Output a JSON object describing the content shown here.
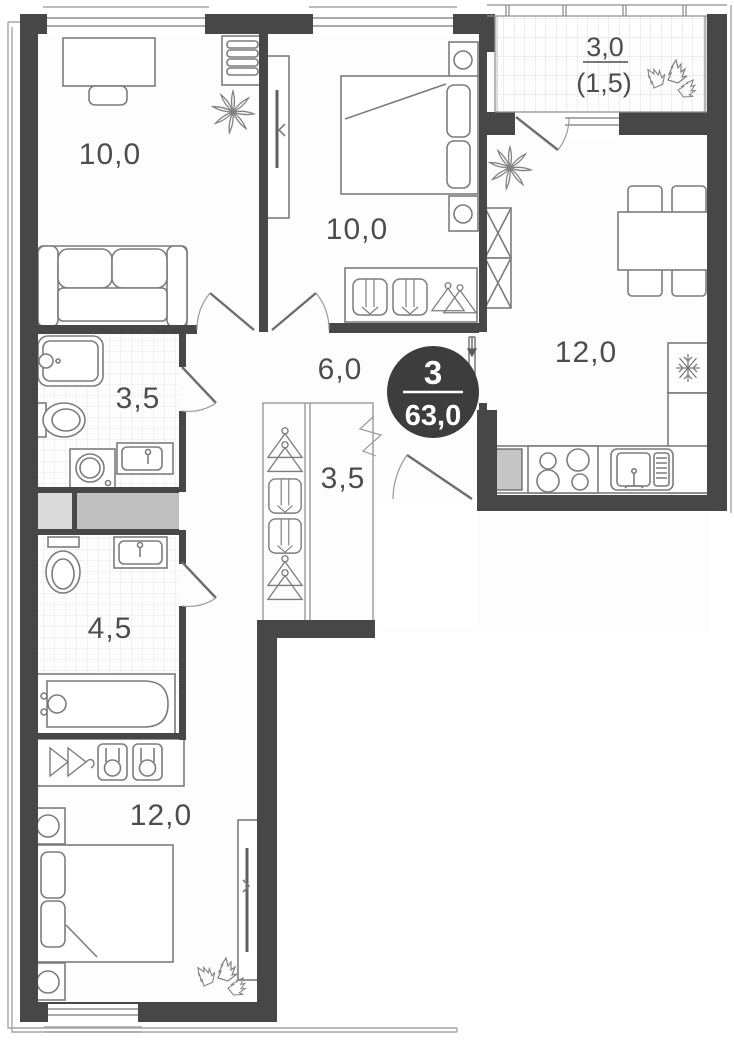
{
  "plan_title": "3-room apartment floor plan",
  "badge": {
    "rooms_count": "3",
    "total_area": "63,0"
  },
  "rooms": {
    "office": {
      "area": "10,0"
    },
    "bedroom_top": {
      "area": "10,0"
    },
    "balcony": {
      "area_total": "3,0",
      "area_counted": "(1,5)"
    },
    "kitchen": {
      "area": "12,0"
    },
    "hallway": {
      "area": "6,0"
    },
    "bathroom_top": {
      "area": "3,5"
    },
    "wardrobe": {
      "area": "3,5"
    },
    "bathroom_bottom": {
      "area": "4,5"
    },
    "bedroom_bottom": {
      "area": "12,0"
    }
  },
  "colors": {
    "wall": "#474747",
    "badge_bg": "#3d3d3d",
    "label": "#4d4d4d",
    "shaft_light": "#dadada",
    "shaft_dark": "#c0c0c0",
    "counter_shaft": "#c6c6c6",
    "tile_line": "#e3e3e3"
  }
}
